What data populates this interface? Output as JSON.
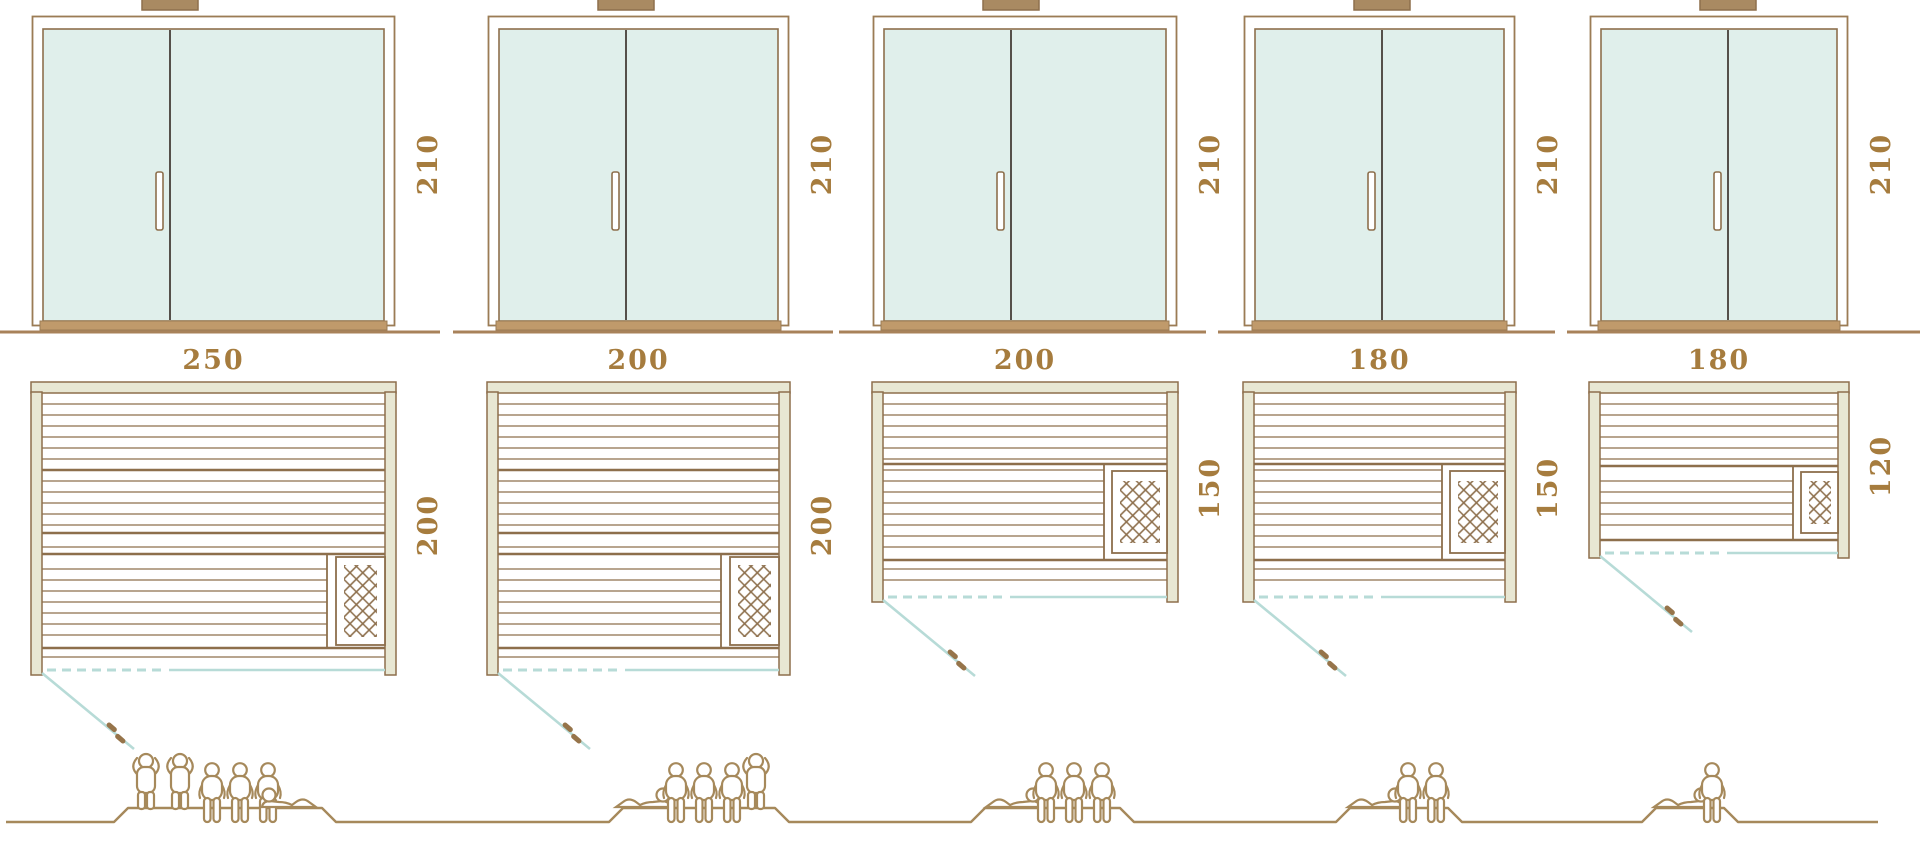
{
  "diagram": {
    "kind": "sauna size comparison diagram",
    "views": [
      "front elevation with glass double door",
      "floor plan with heater and door swing",
      "capacity figures"
    ]
  },
  "colors": {
    "line_brown": "#8d6f4c",
    "label_brown": "#a67c3e",
    "wall_fill": "#e8e7d3",
    "glass_fill": "#e0efeb",
    "teal_line": "#b7dbd7",
    "divider_dark": "#55504a",
    "figure_brown": "#a6895b",
    "ground_brown": "#a8825a",
    "sill_brown": "#c09a6b",
    "cap_brown": "#a98a62",
    "background": "#ffffff"
  },
  "icons": {
    "heater": "heater-crosshatch-icon",
    "door_swing": "door-swing-line",
    "door_handle": "door-handle-icon",
    "standing_person": "standing-person-icon",
    "sitting_person": "sitting-person-icon",
    "lying_person": "lying-person-icon"
  },
  "saunas": [
    {
      "name": "sauna-250x200",
      "width_label": "250",
      "depth_label": "200",
      "height_label": "210",
      "heater_location": "front-right corner",
      "capacity": {
        "standing": 2,
        "sitting": 3,
        "lying": 1
      }
    },
    {
      "name": "sauna-200x200",
      "width_label": "200",
      "depth_label": "200",
      "height_label": "210",
      "heater_location": "front-right corner",
      "capacity": {
        "standing": 1,
        "sitting": 3,
        "lying": 1
      }
    },
    {
      "name": "sauna-200x150",
      "width_label": "200",
      "depth_label": "150",
      "height_label": "210",
      "heater_location": "right wall",
      "capacity": {
        "standing": 0,
        "sitting": 3,
        "lying": 1
      }
    },
    {
      "name": "sauna-180x150",
      "width_label": "180",
      "depth_label": "150",
      "height_label": "210",
      "heater_location": "right wall",
      "capacity": {
        "standing": 0,
        "sitting": 2,
        "lying": 1
      }
    },
    {
      "name": "sauna-180x120",
      "width_label": "180",
      "depth_label": "120",
      "height_label": "210",
      "heater_location": "right wall",
      "capacity": {
        "standing": 0,
        "sitting": 1,
        "lying": 1
      }
    }
  ]
}
